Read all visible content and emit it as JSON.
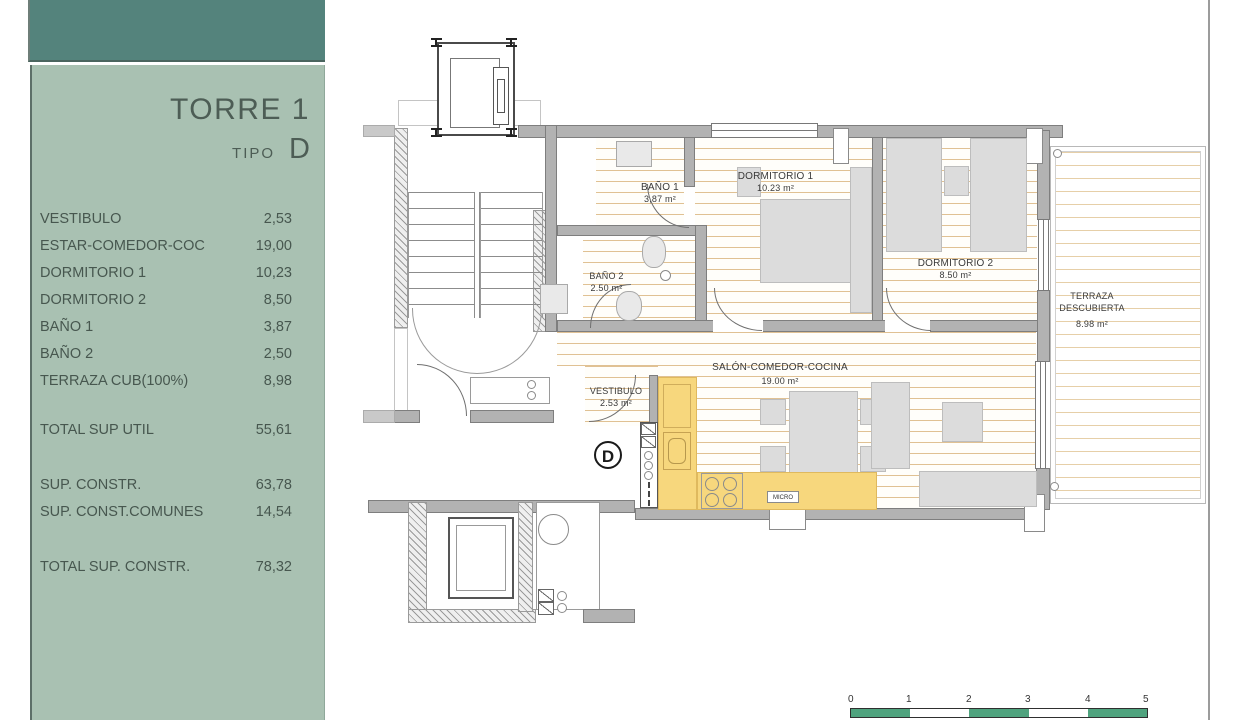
{
  "sidebar": {
    "title": "TORRE 1",
    "tipo_label": "TIPO",
    "tipo_value": "D",
    "rows": [
      {
        "label": "VESTIBULO",
        "value": "2,53"
      },
      {
        "label": "ESTAR-COMEDOR-COC",
        "value": "19,00"
      },
      {
        "label": "DORMITORIO 1",
        "value": "10,23"
      },
      {
        "label": "DORMITORIO 2",
        "value": "8,50"
      },
      {
        "label": "BAÑO 1",
        "value": "3,87"
      },
      {
        "label": "BAÑO 2",
        "value": "2,50"
      },
      {
        "label": "TERRAZA CUB(100%)",
        "value": "8,98"
      }
    ],
    "total_util": {
      "label": "TOTAL SUP UTIL",
      "value": "55,61"
    },
    "constr_rows": [
      {
        "label": "SUP. CONSTR.",
        "value": "63,78"
      },
      {
        "label": "SUP. CONST.COMUNES",
        "value": "14,54"
      }
    ],
    "total_constr": {
      "label": "TOTAL SUP. CONSTR.",
      "value": "78,32"
    }
  },
  "plan": {
    "rooms": {
      "banyo1": {
        "name": "BAÑO 1",
        "area": "3,87 m²"
      },
      "dormitorio1": {
        "name": "DORMITORIO 1",
        "area": "10.23 m²"
      },
      "dormitorio2": {
        "name": "DORMITORIO 2",
        "area": "8.50 m²"
      },
      "banyo2": {
        "name": "BAÑO 2",
        "area": "2.50 m²"
      },
      "salon": {
        "name": "SALÓN-COMEDOR-COCINA",
        "area": "19.00 m²"
      },
      "vestibulo": {
        "name": "VESTIBULO",
        "area": "2.53 m²"
      },
      "terraza": {
        "name_line1": "TERRAZA",
        "name_line2": "DESCUBIERTA",
        "area": "8.98 m²"
      }
    },
    "unit_marker": "D",
    "kitchen_label": "MICRO"
  },
  "scale_bar": {
    "ticks": [
      "0",
      "1",
      "2",
      "3",
      "4",
      "5"
    ]
  },
  "colors": {
    "band_teal": "#54837C",
    "panel_green": "#A9C1B2",
    "scale_green": "#4FA37E",
    "kitchen_yellow": "#F7D77D"
  }
}
